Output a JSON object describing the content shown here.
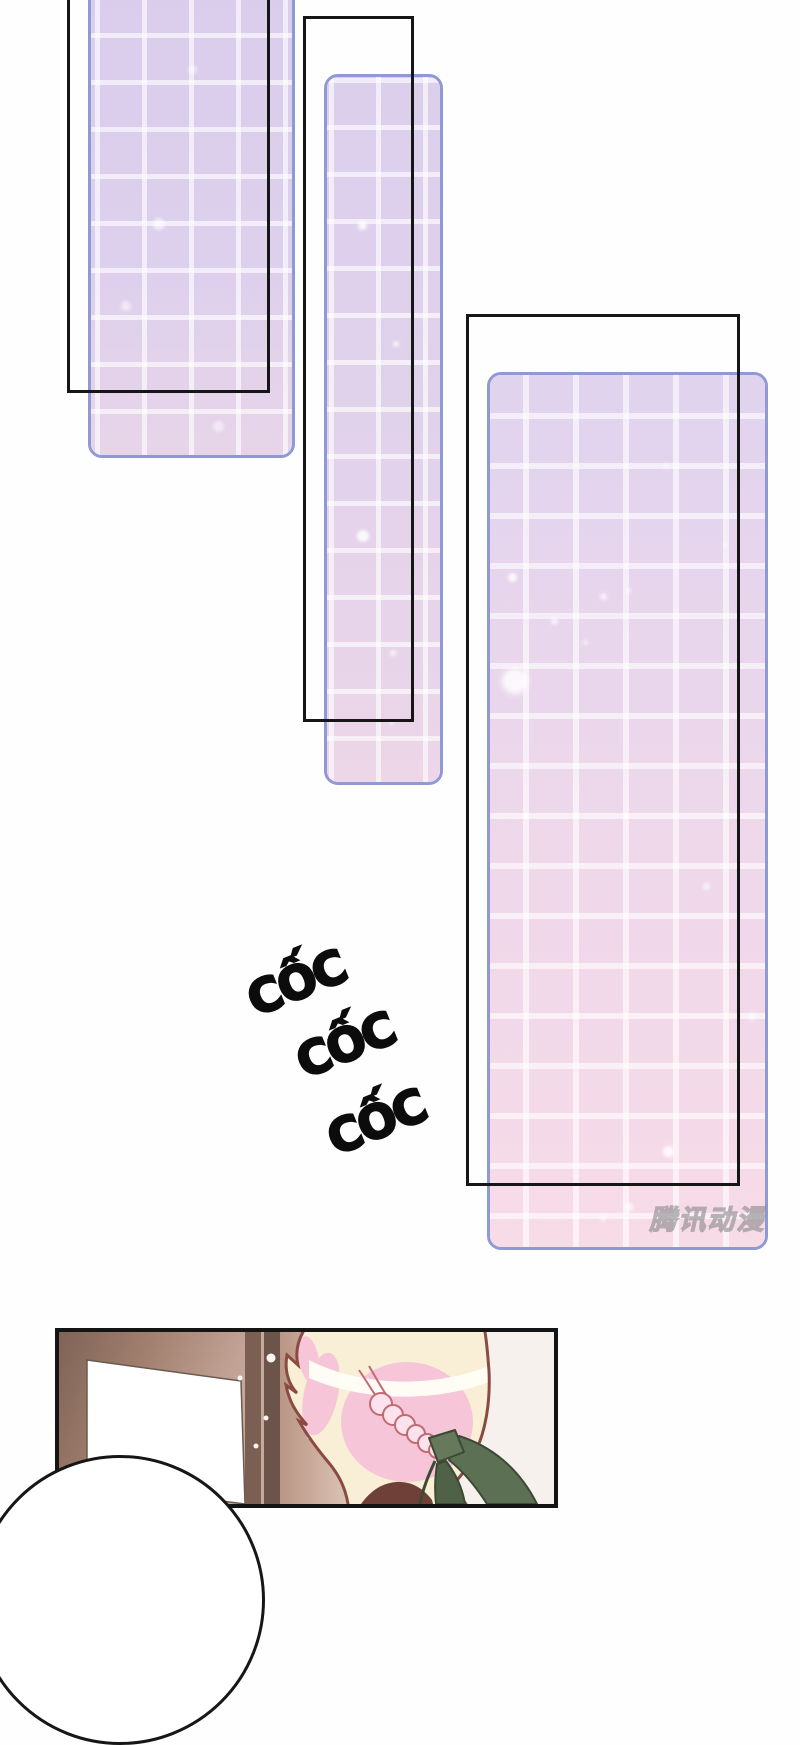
{
  "page": {
    "type": "webtoon-comic-page",
    "background": "#fefefe",
    "panel_count": 4
  },
  "sfx": {
    "items": [
      {
        "text": "CỐC"
      },
      {
        "text": "CỐC"
      },
      {
        "text": "CỐC"
      }
    ],
    "color": "#0c0c0c"
  },
  "watermark": {
    "text": "腾讯动漫",
    "style": "hollow-outline-gray"
  },
  "colors": {
    "glass_panel_border": "#8f99d4",
    "glass_lavender": "#dcd0ec",
    "glass_pink": "#f7dbe7",
    "grid_line": "rgba(255,255,255,0.6)",
    "frame_outline": "#161616",
    "door_brown": "#8a6a5c",
    "wall_mauve": "#bf9f90",
    "hair_cream": "#f9eed6",
    "hair_pink": "#f6c6d8",
    "hair_outline": "#8a4b42",
    "ribbon_green": "#5c7053",
    "bubble_white": "#ffffff"
  }
}
